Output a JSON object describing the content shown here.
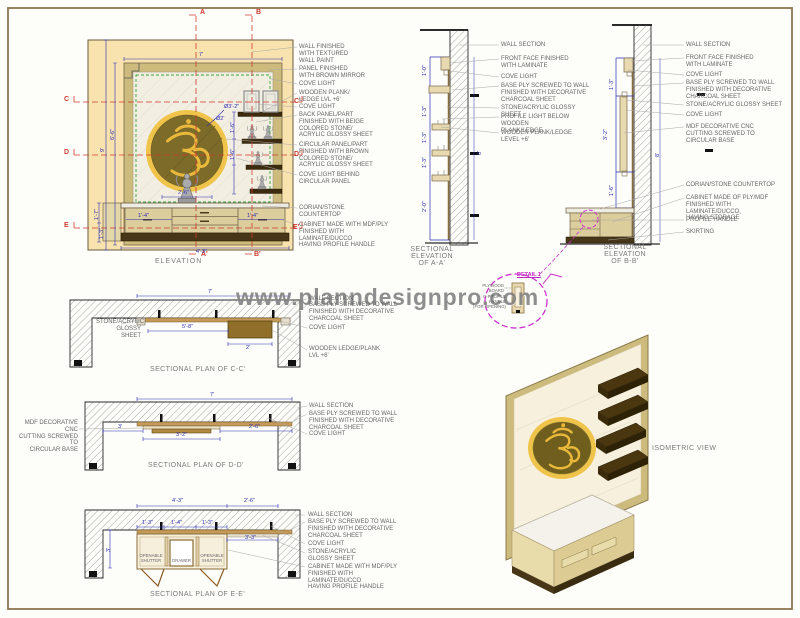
{
  "sheet": {
    "watermark": "www.planndesignpro.com"
  },
  "elevation": {
    "title": "ELEVATION",
    "labels": [
      "WALL FINISHED\nWITH TEXTURED\nWALL PAINT",
      "PANEL FINISHED\nWITH BROWN MIRROR",
      "COVE LIGHT",
      "WOODEN PLANK/\nLEDGE LVL +6'",
      "COVE LIGHT",
      "BACK PANEL/PART\nFINISHED WITH BEIGE\nCOLORED STONE/\nACRYLIC GLOSSY SHEET",
      "CIRCULAR PANEL/PART\nFINISHED WITH BROWN\nCOLORED STONE/\nACRYLIC GLOSSY SHEET",
      "COVE LIGHT BEHIND\nCIRCULAR PANEL",
      "CORIAN/STONE\nCOUNTERTOP",
      "CABINET MADE WITH MDF/PLY\nFINISHED WITH LAMINATE/DUCCO\nHAVING PROFILE HANDLE"
    ],
    "markers": {
      "a": "A",
      "b": "B",
      "a1": "A'",
      "b1": "B'",
      "c": "C",
      "c1": "C'",
      "d": "D",
      "d1": "D'",
      "e": "E",
      "e1": "E'"
    }
  },
  "section_aa": {
    "title": "SECTIONAL\nELEVATION\nOF A-A'",
    "labels": [
      "WALL SECTION",
      "FRONT FACE FINISHED\nWITH LAMINATE",
      "COVE LIGHT",
      "BASE PLY SCREWED TO WALL\nFINISHED WITH DECORATIVE\nCHARCOAL SHEET",
      "STONE/ACRYLIC GLOSSY SHEET",
      "PROFILE LIGHT BELOW WOODEN\nPLANK/LEDGE",
      "WOODEN PLANK/LEDGE\nLEVEL +6'"
    ]
  },
  "section_bb": {
    "title": "SECTIONAL\nELEVATION\nOF B-B'",
    "labels": [
      "WALL SECTION",
      "FRONT FACE FINISHED\nWITH LAMINATE",
      "COVE LIGHT",
      "BASE PLY SCREWED TO WALL\nFINISHED WITH DECORATIVE\nCHARCOAL SHEET",
      "STONE/ACRYLIC GLOSSY SHEET",
      "COVE LIGHT",
      "MDF DECORATIVE CNC\nCUTTING SCREWED TO\nCIRCULAR BASE",
      "CORIAN/STONE COUNTERTOP",
      "CABINET MADE OF PLY/MDF\nFINISHED WITH LAMINATE/DUCCO,\nHAVING STORAGE",
      "PROFILE HANDLE",
      "SKIRTING"
    ]
  },
  "plan_cc": {
    "title": "SECTIONAL PLAN OF C-C'",
    "left_label": "STONE/ACRYLIC\nGLOSSY SHEET",
    "labels": [
      "WALL SECTION",
      "BASE PLY SCREWED TO WALL\nFINISHED WITH DECORATIVE\nCHARCOAL SHEET",
      "COVE LIGHT",
      "WOODEN LEDGE/PLANK\nLVL +6'"
    ]
  },
  "plan_dd": {
    "title": "SECTIONAL PLAN OF D-D'",
    "left_label": "MDF DECORATIVE CNC\nCUTTING SCREWED TO\nCIRCULAR BASE",
    "labels": [
      "WALL SECTION",
      "BASE PLY SCREWED TO WALL\nFINISHED WITH DECORATIVE\nCHARCOAL SHEET",
      "COVE LIGHT"
    ]
  },
  "plan_ee": {
    "title": "SECTIONAL PLAN OF E-E'",
    "labels": [
      "WALL SECTION",
      "BASE PLY SCREWED TO WALL\nFINISHED WITH DECORATIVE\nCHARCOAL SHEET",
      "COVE LIGHT",
      "STONE/ACRYLIC\nGLOSSY SHEET",
      "CABINET MADE WITH MDF/PLY\nFINISHED WITH LAMINATE/DUCCO\nHAVING PROFILE HANDLE"
    ],
    "shutter_left": "OPENABLE\nSHUTTER",
    "drawer": "DRAWER",
    "shutter_right": "OPENABLE\nSHUTTER"
  },
  "detail": {
    "title": "DETAIL 1",
    "labels": [
      "PLYWOOD BOARD",
      "C-PROFILE HANDLE\n(FOR OPENING)"
    ]
  },
  "isometric": {
    "title": "ISOMETRIC VIEW"
  },
  "dims": [
    "9'",
    "6'-6\"",
    "7'",
    "Ø3'-2\"",
    "Ø2'",
    "2'-6\"",
    "1'-7\"",
    "1'-3\"",
    "4'-3\"",
    "1'-6\"",
    "1'-6\"",
    "1'-4\"",
    "1'-4\"",
    "1'-0\"",
    "1'-3\"",
    "1'-3\"",
    "1'-3\"",
    "2'-0\"",
    "8'",
    "1'-3\"",
    "3'-2\"",
    "1'-6\"",
    "8'",
    "7'",
    "5'-8\"",
    "2'",
    "7'",
    "3'",
    "2'-6\"",
    "3'-2\"",
    "4'-3\"",
    "2'-6\"",
    "1'-3\"",
    "1'-4\"",
    "1'-3\"",
    "3'-3\"",
    "3'"
  ],
  "colors": {
    "wall_paint": "#f8e3ae",
    "frame_wood": "#cdbb7d",
    "circle_panel": "#7c6b29",
    "gold_ring": "#f0c44a",
    "shelf_dark": "#3c2b0f",
    "section_marker_red": "#cf3b2e",
    "dimension_blue": "#2e2eb4",
    "detail_magenta": "#cc33cc",
    "cove_green": "#3aa53a"
  }
}
